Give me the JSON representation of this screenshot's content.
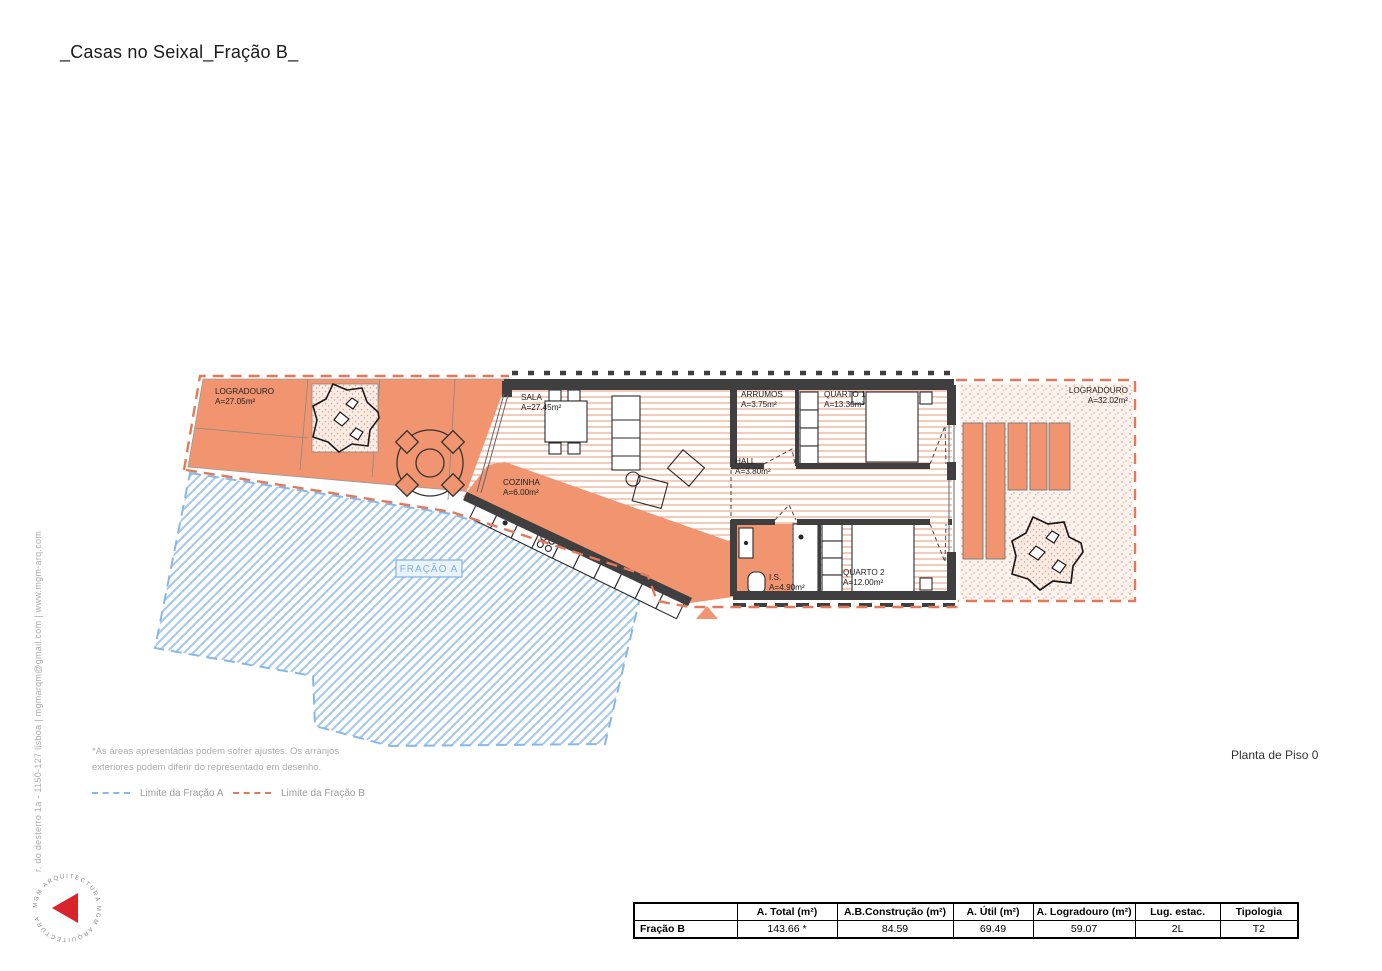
{
  "title": "_Casas no Seixal_Fração B_",
  "drawing_title": "Planta de Piso 0",
  "footer_address": "r. do desterro 1a - 1150-127 lisboa | mgmarqm@gmail.com | www.mgm-arq.com",
  "logo_text": "MGM ARQUITECTURA   MGM ARQUITECTURA",
  "notes": {
    "line1": "*As áreas apresentadas podem sofrer ajustes. Os arranjos",
    "line2": "exteriores podem diferir do representado em desenho."
  },
  "legend": {
    "fracao_a": "Limite da Fração A",
    "fracao_b": "Limite da Fração B"
  },
  "plan": {
    "fracao_a_label": "FRAÇÃO A",
    "rooms": [
      {
        "name": "LOGRADOURO",
        "area": "A=27.05m²"
      },
      {
        "name": "SALA",
        "area": "A=27.45m²"
      },
      {
        "name": "COZINHA",
        "area": "A=6.00m²"
      },
      {
        "name": "ARRUMOS",
        "area": "A=3.75m²"
      },
      {
        "name": "QUARTO 1",
        "area": "A=13.30m²"
      },
      {
        "name": "HALL",
        "area": "A=3.80m²"
      },
      {
        "name": "I.S.",
        "area": "A=4.90m²"
      },
      {
        "name": "QUARTO 2",
        "area": "A=12.00m²"
      },
      {
        "name": "LOGRADOURO",
        "area": "A=32.02m²"
      }
    ]
  },
  "table": {
    "headers": [
      "",
      "A. Total (m²)",
      "A.B.Construção (m²)",
      "A. Útil (m²)",
      "A. Logradouro (m²)",
      "Lug. estac.",
      "Tipologia"
    ],
    "rows": [
      [
        "Fração B",
        "143.66 *",
        "84.59",
        "69.49",
        "59.07",
        "2L",
        "T2"
      ]
    ]
  },
  "colors": {
    "salmon_fill": "#F19470",
    "orange_line": "#E2795B",
    "floor_hatch": "#E8A183",
    "blue_hatch": "#A6C9ED",
    "blue_dash": "#88B8E9",
    "wall": "#3F3F3F"
  }
}
